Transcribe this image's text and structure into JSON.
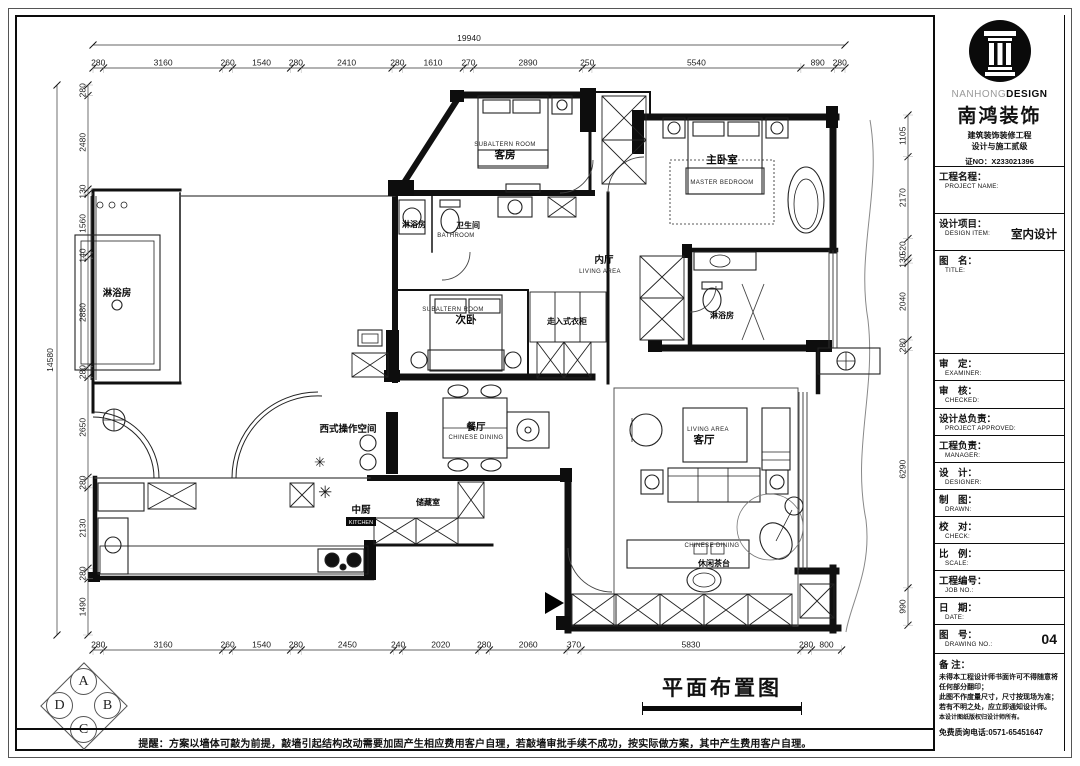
{
  "title_block": {
    "logo": {
      "brand_gray": "NANHONG",
      "brand_bold": "DESIGN",
      "company": "南鸿装饰",
      "cert_line1": "建筑装饰装修工程",
      "cert_line2": "设计与施工贰级",
      "cert_no": "证NO：X233021396"
    },
    "fields": [
      {
        "cn": "工程名程：",
        "en": "PROJECT NAME:",
        "value": ""
      },
      {
        "cn": "设计项目：",
        "en": "DESIGN ITEM:",
        "value": "室内设计"
      },
      {
        "cn": "图　名：",
        "en": "TITLE:",
        "value": ""
      },
      {
        "cn": "审　定：",
        "en": "EXAMINER:",
        "value": ""
      },
      {
        "cn": "审　核：",
        "en": "CHECKED:",
        "value": ""
      },
      {
        "cn": "设计总负责：",
        "en": "PROJECT APPROVED:",
        "value": ""
      },
      {
        "cn": "工程负责：",
        "en": "MANAGER:",
        "value": ""
      },
      {
        "cn": "设　计：",
        "en": "DESIGNER:",
        "value": ""
      },
      {
        "cn": "制　图：",
        "en": "DRAWN:",
        "value": ""
      },
      {
        "cn": "校　对：",
        "en": "CHECK:",
        "value": ""
      },
      {
        "cn": "比　例：",
        "en": "SCALE:",
        "value": ""
      },
      {
        "cn": "工程编号：",
        "en": "JOB NO.:",
        "value": ""
      },
      {
        "cn": "日　期：",
        "en": "DATE:",
        "value": ""
      },
      {
        "cn": "图　号：",
        "en": "DRAWING NO.:",
        "value": "04"
      }
    ],
    "notes": {
      "title": "备 注：",
      "lines": [
        "未得本工程设计师书面许可不得随意将任何部分翻印；",
        "此图不作度量尺寸，尺寸按现场为准；",
        "若有不明之处，应立即通知设计师。",
        "本设计图纸版权归设计师所有。"
      ],
      "phone": "免费质询电话:0571-65451647"
    }
  },
  "drawing": {
    "title": "平面布置图",
    "reminder": "提醒：方案以墙体可敲为前提，敲墙引起结构改动需要加固产生相应费用客户自理，若敲墙审批手续不成功，按实际做方案，其中产生费用客户自理。",
    "compass": {
      "top": "A",
      "right": "B",
      "bottom": "C",
      "left": "D"
    }
  },
  "rooms": {
    "guest": {
      "cn": "客房",
      "en": "SUBALTERN ROOM"
    },
    "master": {
      "cn": "主卧室",
      "en": "MASTER BEDROOM"
    },
    "second": {
      "cn": "次卧",
      "en": "SUBALTERN ROOM"
    },
    "bathroom": {
      "cn": "卫生间",
      "en": "BATHROOM"
    },
    "shower_left": {
      "cn": "淋浴房"
    },
    "shower_mid": {
      "cn": "淋浴房"
    },
    "shower_right": {
      "cn": "淋浴房"
    },
    "inner_hall": {
      "cn": "内厅",
      "en": "LIVING AREA"
    },
    "walkin_closet": {
      "cn": "走入式衣柜"
    },
    "west_kitchen": {
      "cn": "西式操作空间"
    },
    "dining": {
      "cn": "餐厅",
      "en": "CHINESE DINING"
    },
    "living": {
      "cn": "客厅",
      "en": "LIVING AREA"
    },
    "tea_table": {
      "cn": "休闲茶台",
      "en": "CHINESE DINING"
    },
    "kitchen": {
      "cn": "中厨",
      "en": "KITCHEN"
    },
    "storage": {
      "cn": "储藏室"
    }
  },
  "dimensions": {
    "overall_width": "19940",
    "overall_height": "14580",
    "top": [
      "280",
      "3160",
      "260",
      "1540",
      "280",
      "2410",
      "280",
      "1610",
      "270",
      "2890",
      "250",
      "5540",
      "890",
      "280"
    ],
    "bottom": [
      "280",
      "3160",
      "260",
      "1540",
      "280",
      "2450",
      "240",
      "2020",
      "280",
      "2060",
      "370",
      "5830",
      "280",
      "800"
    ],
    "left": [
      "280",
      "2480",
      "130",
      "1560",
      "140",
      "2880",
      "280",
      "2650",
      "280",
      "2130",
      "280",
      "1490"
    ],
    "right": [
      "1105",
      "2170",
      "520",
      "130",
      "2040",
      "280",
      "6290",
      "990"
    ]
  }
}
